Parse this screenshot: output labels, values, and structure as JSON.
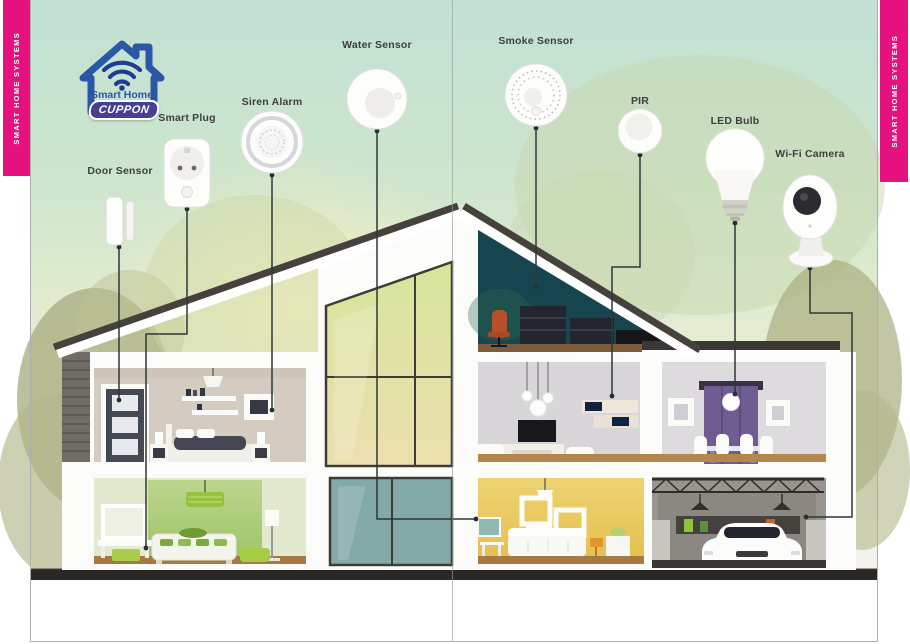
{
  "sidebars": {
    "left": "SMART HOME SYSTEMS",
    "right": "SMART HOME SYSTEMS",
    "color": "#e5117e"
  },
  "logo": {
    "title": "Smart Home",
    "badge": "CUPPON",
    "house_color": "#2b57a7",
    "badge_color": "#473f92"
  },
  "devices": [
    {
      "id": "door-sensor",
      "label": "Door Sensor"
    },
    {
      "id": "smart-plug",
      "label": "Smart Plug"
    },
    {
      "id": "siren-alarm",
      "label": "Siren Alarm"
    },
    {
      "id": "water-sensor",
      "label": "Water Sensor"
    },
    {
      "id": "smoke-sensor",
      "label": "Smoke Sensor"
    },
    {
      "id": "pir",
      "label": "PIR"
    },
    {
      "id": "led-bulb",
      "label": "LED Bulb"
    },
    {
      "id": "wifi-camera",
      "label": "Wi-Fi Camera"
    }
  ],
  "colors": {
    "connector_line": "#2c3836",
    "foundation": "#2b2724",
    "attic_teal": "#17454f",
    "yellow_room": "#e9c85a",
    "green_room": "#a9ca77",
    "garage_gray": "#99958e"
  }
}
